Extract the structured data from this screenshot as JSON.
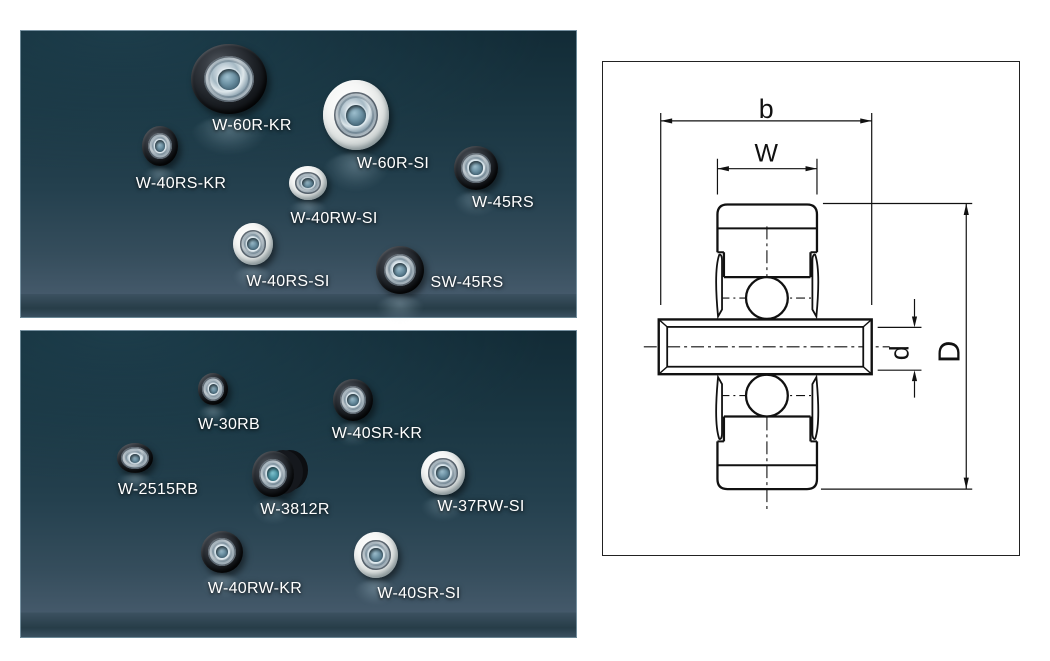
{
  "panels": {
    "top": {
      "items": [
        {
          "label": "W-60R-KR",
          "tire": "black"
        },
        {
          "label": "W-60R-SI",
          "tire": "white"
        },
        {
          "label": "W-40RS-KR",
          "tire": "black"
        },
        {
          "label": "W-40RW-SI",
          "tire": "white"
        },
        {
          "label": "W-45RS",
          "tire": "black"
        },
        {
          "label": "W-40RS-SI",
          "tire": "white"
        },
        {
          "label": "SW-45RS",
          "tire": "black"
        }
      ]
    },
    "bottom": {
      "items": [
        {
          "label": "W-30RB",
          "tire": "black"
        },
        {
          "label": "W-40SR-KR",
          "tire": "black"
        },
        {
          "label": "W-2515RB",
          "tire": "black"
        },
        {
          "label": "W-3812R",
          "tire": "black"
        },
        {
          "label": "W-37RW-SI",
          "tire": "white"
        },
        {
          "label": "W-40RW-KR",
          "tire": "black"
        },
        {
          "label": "W-40SR-SI",
          "tire": "white"
        }
      ]
    }
  },
  "diagram": {
    "dims": {
      "b": "b",
      "W": "W",
      "d": "d",
      "D": "D"
    }
  },
  "colors": {
    "panel_dark": "#14303c",
    "panel_light": "#44596a",
    "tire_black": "#15181c",
    "tire_white": "#eef0ef",
    "hub_metal": "#b7c8d3",
    "bore_blue": "#4f7386",
    "line": "#111111"
  }
}
